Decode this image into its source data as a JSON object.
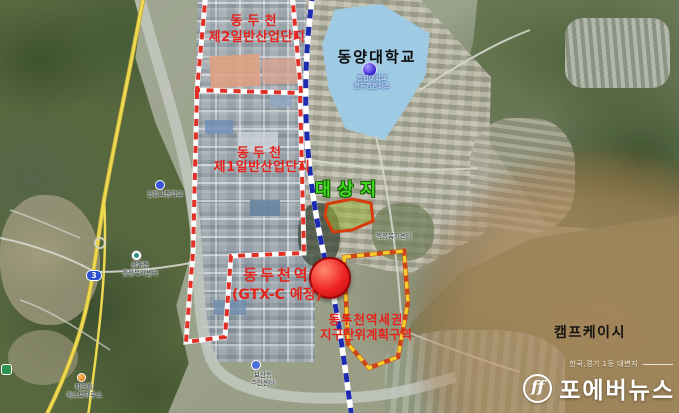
{
  "image": {
    "width": 679,
    "height": 413,
    "kind": "satellite-map news graphic of Dongducheon"
  },
  "map": {
    "zones": {
      "industrial2": {
        "line1": "동두천",
        "line2": "제2일반산업단지",
        "boundary_style": "red-white dashed"
      },
      "industrial1": {
        "line1": "동두천",
        "line2": "제1일반산업단지",
        "boundary_style": "red-white dashed"
      },
      "station_district": {
        "line1": "동두천역세권",
        "line2": "지구단위계획구역",
        "boundary_style": "yellow-orange dashed"
      }
    },
    "labels": {
      "university": "동양대학교",
      "target_site": "대상지",
      "station_line1": "동두천역",
      "station_line2": "(GTX-C 예정)",
      "camp": "캠프케이시"
    },
    "small_labels": [
      {
        "text": "신흥고등학교"
      },
      {
        "line1": "동양대학교",
        "line2": "동두천캠퍼스"
      },
      {
        "line1": "상패동",
        "line2": "행정복지센터"
      },
      {
        "line1": "보산동",
        "line2": "주민센터"
      },
      {
        "line1": "파인힐",
        "line2": "게스트하우스"
      },
      {
        "text": "행정복지센터"
      }
    ],
    "route_badge": {
      "label": "3"
    },
    "colors": {
      "annotation_red": "#e5231d",
      "target_green": "#44dd22",
      "railway_blue": "#1c2bb0",
      "boundary_red": "#e03028",
      "district_yellow": "#f4cf2a",
      "site_border": "#d63c0c",
      "camp_tint": "#946034",
      "campus_fill": "#9ecbe8"
    }
  },
  "watermark": {
    "slogan": "한국,경기 1등 대변지",
    "brand": "포에버뉴스",
    "logo_glyph": "ff"
  }
}
